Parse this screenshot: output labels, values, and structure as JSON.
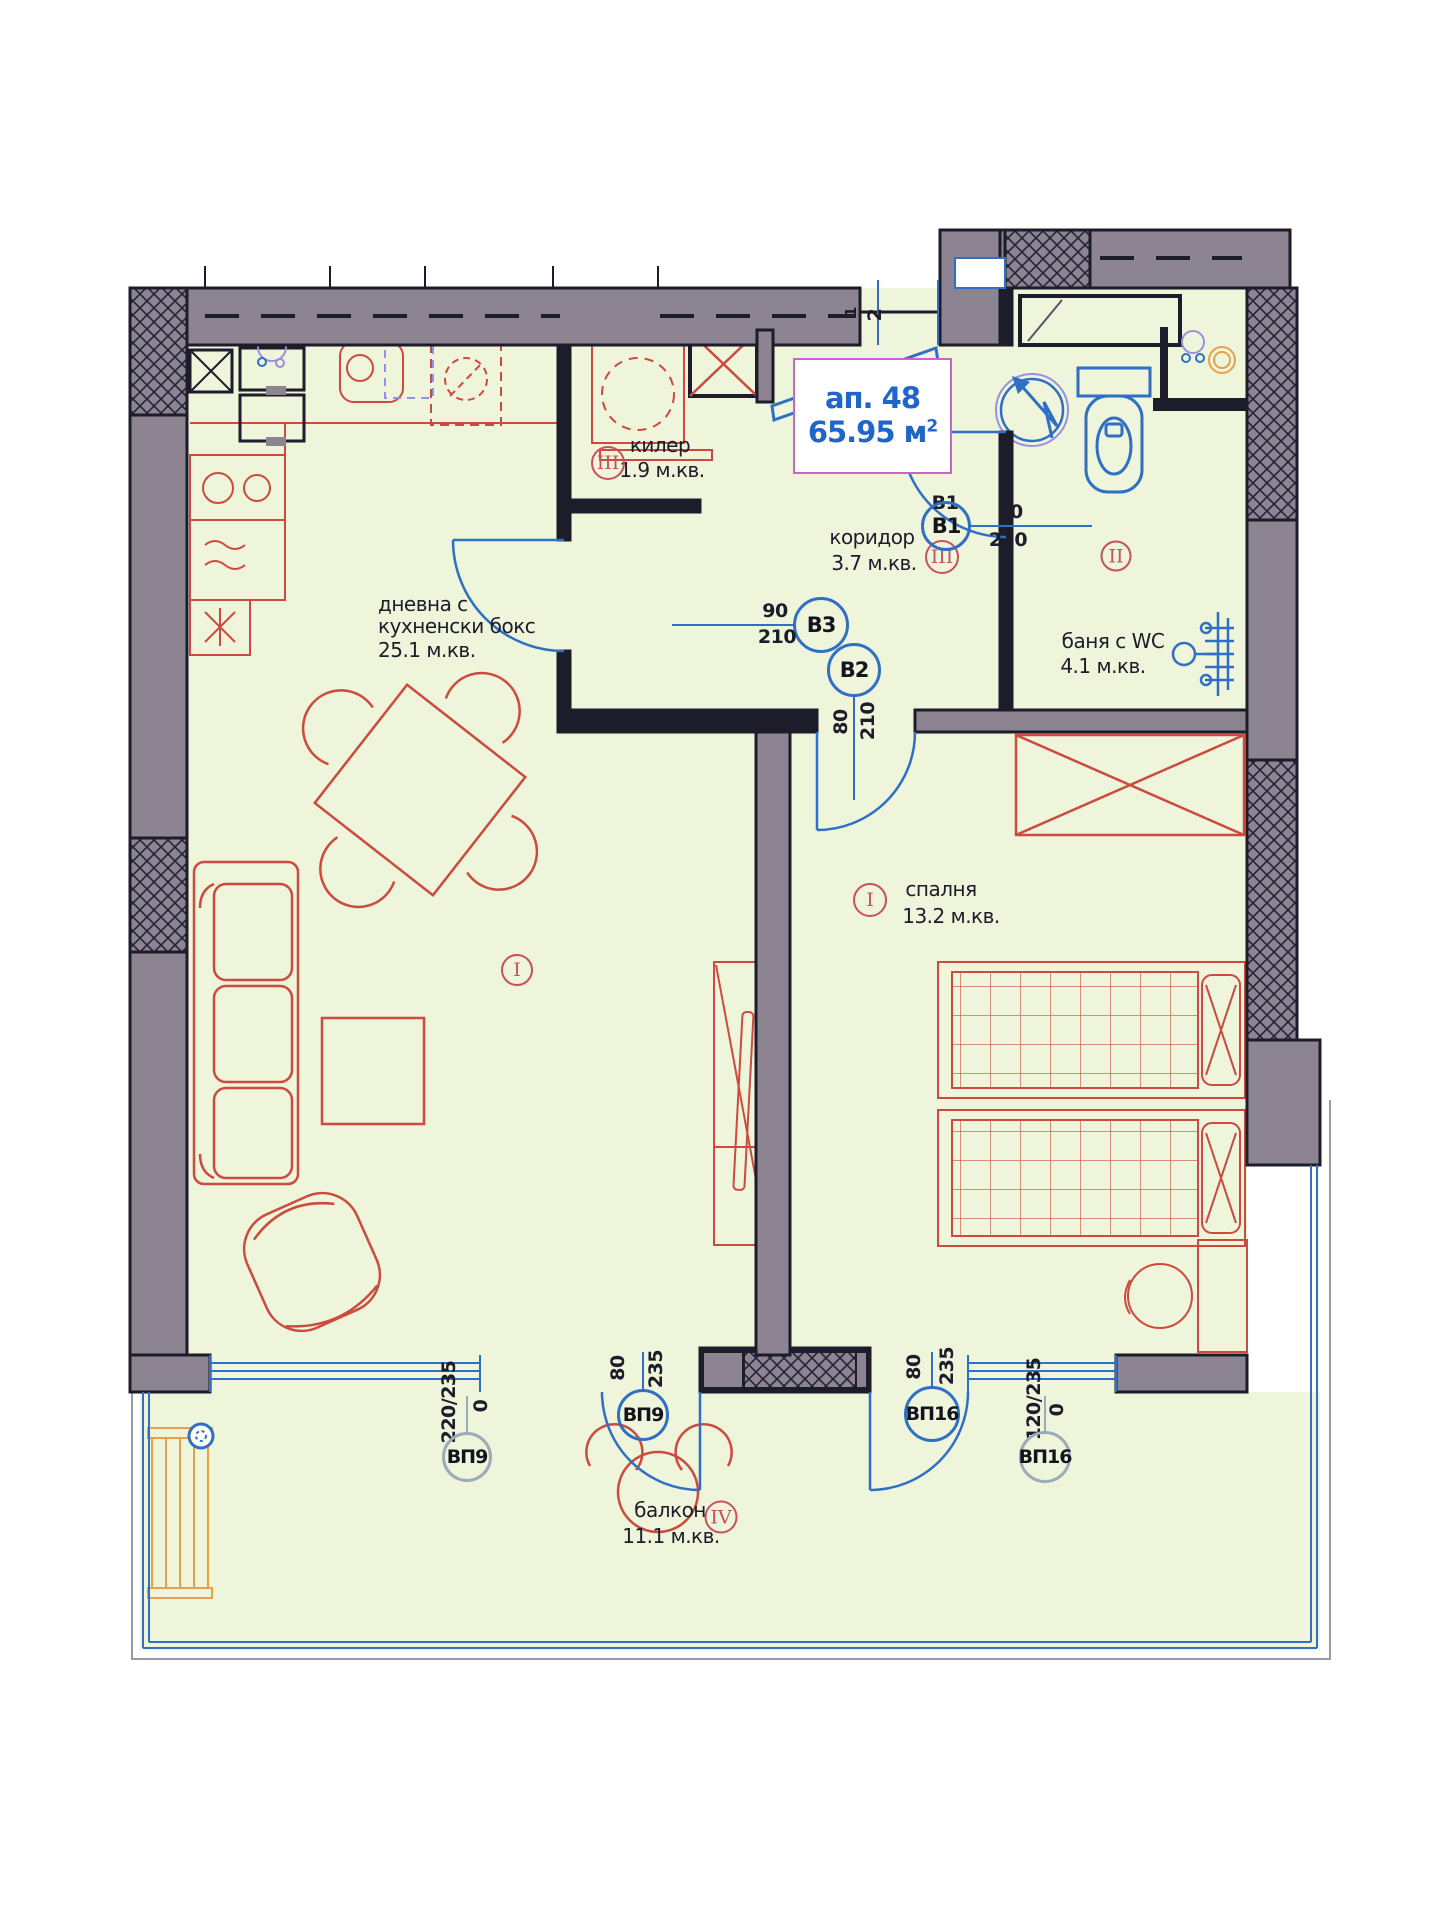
{
  "title_box": {
    "apartment_no": "ап. 48",
    "area_main": "65.95 м",
    "area_exp": "2"
  },
  "rooms": {
    "living": {
      "name_l1": "дневна с",
      "name_l2": "кухненски бокс",
      "area": "25.1 м.кв.",
      "marker": "I"
    },
    "pantry": {
      "name": "килер",
      "area": "1.9 м.кв.",
      "marker": "III"
    },
    "corridor": {
      "name": "коридор",
      "area": "3.7 м.кв.",
      "marker": "III"
    },
    "bathroom": {
      "name": "баня с WC",
      "area": "4.1 м.кв.",
      "marker": "II"
    },
    "bedroom": {
      "name": "спалня",
      "area": "13.2 м.кв.",
      "marker": "I"
    },
    "balcony": {
      "name": "балкон",
      "area": "11.1 м.кв.",
      "marker": "IV"
    }
  },
  "doors": {
    "b1": {
      "id": "В1",
      "tag": "В1",
      "w": "70",
      "h": "210"
    },
    "b2": {
      "id": "В2",
      "w": "80",
      "h": "210"
    },
    "b3": {
      "id": "В3",
      "w": "90",
      "h": "210"
    }
  },
  "windows": {
    "vp9_window": {
      "id": "ВП9",
      "dim": "220/235",
      "zero": "0"
    },
    "vp9_door": {
      "id": "ВП9",
      "w": "80",
      "h": "235"
    },
    "vp16_door": {
      "id": "ВП16",
      "w": "80",
      "h": "235"
    },
    "vp16_window": {
      "id": "ВП16",
      "dim": "120/235",
      "zero": "0"
    }
  },
  "entry_dims": {
    "d1": "1",
    "d2": "2"
  },
  "colors": {
    "floor": "#eef5da",
    "wall": "#8d8492",
    "outline": "#1c1c2a",
    "blue": "#2f6fc6",
    "red": "#cd4a3e",
    "orange": "#e8a04a",
    "marker_red": "#c9505c",
    "title_blue": "#2066c8",
    "title_border": "#c963cf"
  }
}
